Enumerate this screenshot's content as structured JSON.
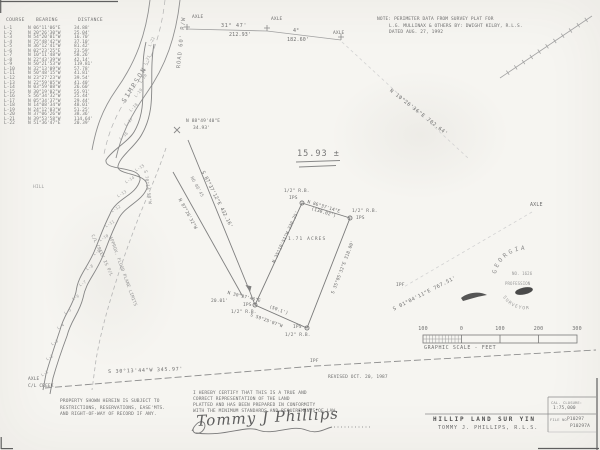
{
  "table": {
    "headers": [
      "COURSE",
      "BEARING",
      "DISTANCE"
    ],
    "rows": [
      [
        "L-1",
        "N 06°11'06\"E",
        "34.88'"
      ],
      [
        "L-2",
        "N 20°26'30\"W",
        "25.04'"
      ],
      [
        "L-3",
        "N 54°20'01\"W",
        "16.70'"
      ],
      [
        "L-4",
        "N 75°48'42\"W",
        "37.10'"
      ],
      [
        "L-5",
        "N 36°12'41\"W",
        "81.42'"
      ],
      [
        "L-6",
        "N 02°23'25\"E",
        "23.59'"
      ],
      [
        "L-7",
        "N 10°11'48\"W",
        "58.26'"
      ],
      [
        "L-8",
        "N 22°43'39\"W",
        "42.14'"
      ],
      [
        "L-9",
        "N 50°21'53\"W",
        "119.81'"
      ],
      [
        "L-10",
        "N 32°13'09\"W",
        "57.78'"
      ],
      [
        "L-11",
        "N 50°48'15\"W",
        "41.81'"
      ],
      [
        "L-12",
        "N 23°27'23\"W",
        "39.54'"
      ],
      [
        "L-13",
        "N 22°59'05\"W",
        "41.40'"
      ],
      [
        "L-14",
        "N 03°59'08\"W",
        "26.60'"
      ],
      [
        "L-15",
        "N 30°19'02\"W",
        "55.91'"
      ],
      [
        "L-16",
        "S 56°34'32\"W",
        "25.44'"
      ],
      [
        "L-17",
        "N 05°34'37\"W",
        "29.44'"
      ],
      [
        "L-18",
        "N 14°08'34\"W",
        "48.01'"
      ],
      [
        "L-19",
        "N 24°12'03\"W",
        "51.25'"
      ],
      [
        "L-20",
        "N 37°06'26\"W",
        "38.36'"
      ],
      [
        "L-21",
        "N 39°53'58\"W",
        "114.64'"
      ],
      [
        "L-22",
        "N 51°36'47\"E",
        "20.39'"
      ]
    ]
  },
  "note": {
    "line1": "NOTE: PERIMETER DATA FROM SURVEY PLAT FOR",
    "line2": "L.G. MULLINAX & OTHERS BY: DWIGHT KILBY, R.L.S.",
    "line3": "DATED AUG. 27, 1992"
  },
  "road": {
    "name": "SIMPSON",
    "rw": "ROAD 60' R/W"
  },
  "top_boundary": {
    "axle": "AXLE",
    "seg1_bearing": "31° 47'",
    "seg1_dist": "212.93'",
    "seg2_bearing": "4°",
    "seg2_dist": "182.60'"
  },
  "east_boundary": {
    "course1": "N 10°26'36\"E  702.64'",
    "course2": "S 01°04'11\"E  767.51'",
    "axle": "AXLE",
    "ipf": "IPF"
  },
  "south_boundary": {
    "course": "S 30°13'44\"W  345.97'",
    "ipf": "IPF",
    "revised": "REVISED OCT. 20, 1987"
  },
  "creek": {
    "axle": "AXLE",
    "cl": "C/L CREEK",
    "cl_pl": "C/L CREEK IS P/L",
    "flood": "APPROX. FLOOD PLANE LIMITS",
    "flood_bearing": "S 70°14'50\"W",
    "hill": "HILL"
  },
  "tract": {
    "area": "15.93 ±"
  },
  "tie": {
    "bearing": "N 88°49'40\"E",
    "dist": "34.93'"
  },
  "v_strip": {
    "east": "S 87°37'12\"E  432.16'",
    "west": "N 87°26'32\"W",
    "ref": "NO 08'45",
    "tie_bearing": "N 30°37'46\"E",
    "tie_dist": "20.01'"
  },
  "parcel": {
    "area": "1.71 ACRES",
    "north_bearing": "N 86°37'14\"E",
    "north_dist": "(130.02')",
    "east_course": "S 35°05'32\"E  318.00'",
    "west_course": "N 35°10'51\"W  230.25'",
    "south_bearing": "S 59°25'07\"W",
    "south_dist": "(50.1')",
    "ips": "IPS",
    "rb": "1/2\" R.B."
  },
  "property_note": {
    "line1": "PROPERTY SHOWN HEREIN IS SUBJECT TO",
    "line2": "RESTRICTIONS, RESERVATIONS, EASE'MTS.",
    "line3": "AND RIGHT-OF-WAY OF RECORD IF ANY."
  },
  "certification": {
    "line1": "I HEREBY CERTIFY THAT THIS IS A TRUE AND",
    "line2": "CORRECT REPRESENTATION OF THE LAND",
    "line3": "PLATTED AND HAS BEEN PREPARED IN CONFORMITY",
    "line4": "WITH THE MINIMUM STANDARDS AND REQUIREMENTS OF LAW.",
    "signature": "Tommy J Phillips"
  },
  "scale_bar": {
    "tick1": "100",
    "tick2": "0",
    "tick3": "100",
    "tick4": "200",
    "tick5": "300",
    "caption": "GRAPHIC SCALE - FEET"
  },
  "seal": {
    "state": "GEORGIA",
    "number": "NO. 1626",
    "line1": "PROFESSION",
    "line2": "SURVEYOR"
  },
  "title_block": {
    "firm": "HILLIP  LAND SUR  YIN",
    "surveyor": "TOMMY J. PHILLIPS, R.L.S.",
    "closure_label": "CAL. CLOSURE:",
    "closure_value": "1:75,000",
    "file_label": "FILE NO.",
    "file_no_1": "P10297",
    "file_no_2": "P10297A"
  }
}
